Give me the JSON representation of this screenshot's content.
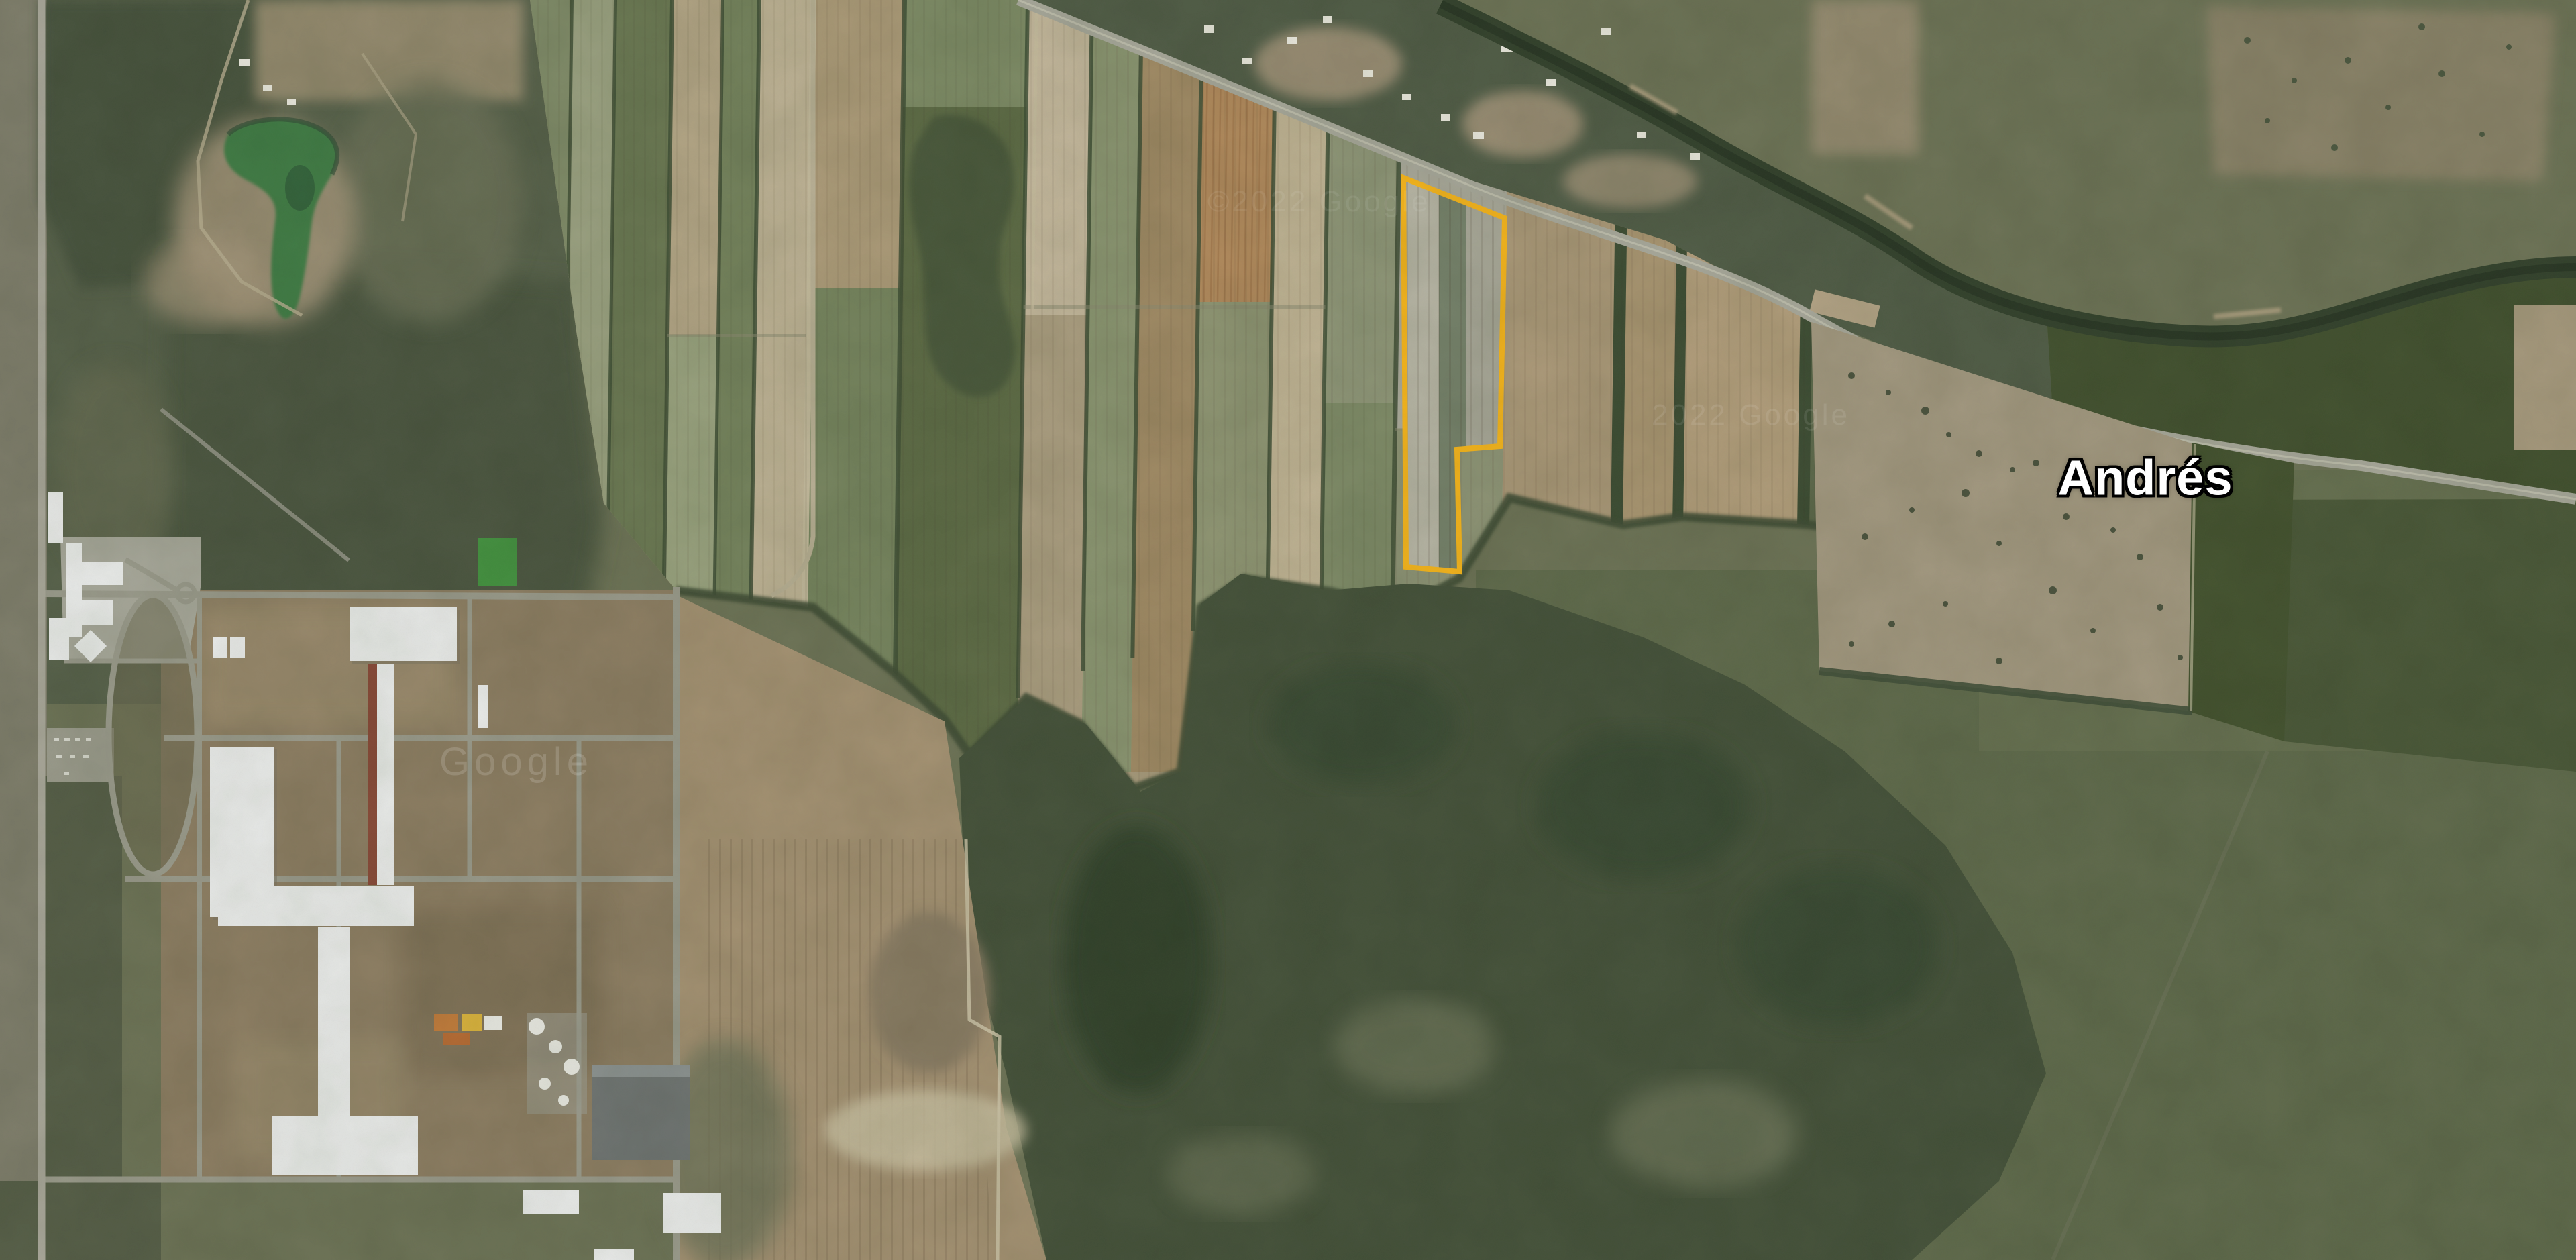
{
  "map": {
    "place_label": "Andrés",
    "label_color": "#ffffff",
    "label_outline_color": "#000000"
  },
  "watermarks": {
    "google_large": "Google",
    "copyright_faint_1": "©2022 Google",
    "copyright_faint_2": "2022 Google",
    "color": "#ffffff"
  },
  "parcel": {
    "name": "highlighted-parcel",
    "outline_color": "#F7B51A",
    "fill": "none"
  }
}
